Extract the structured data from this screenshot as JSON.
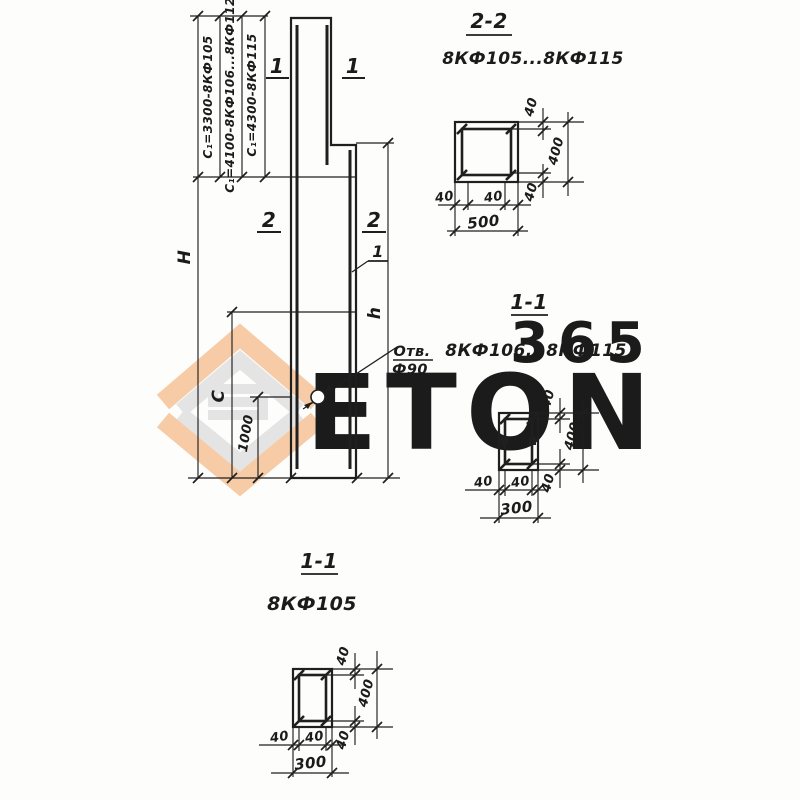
{
  "watermark": {
    "number": "365",
    "brand": "ETON",
    "orange": "#f6cba6",
    "gray": "#e4e4e4",
    "number_color": "#f1bc9c"
  },
  "elevation": {
    "c1_labels": [
      "С₁=3300-8КФ105",
      "С₁=4100-8КФ106...8КФ112",
      "С₁=4300-8КФ115"
    ],
    "total_height_label": "Н",
    "c_label": "С",
    "hole_offset_label": "1000",
    "h_label": "h",
    "hole_note_line1": "Отв.",
    "hole_note_line2": "Ф90",
    "cut1_left": "1",
    "cut1_right": "1",
    "cut2_left": "2",
    "cut2_right": "2",
    "rebar_mark": "1"
  },
  "section22": {
    "title": "2-2",
    "range": "8КФ105...8КФ115",
    "cover_top": "40",
    "cover_bottom": "40",
    "cover_left": "40",
    "cover_right": "40",
    "height": "400",
    "width": "500"
  },
  "section11r": {
    "title": "1-1",
    "range": "8КФ106...8КФ115",
    "cover_top": "40",
    "cover_bottom": "40",
    "cover_left": "40",
    "cover_right": "40",
    "height": "400",
    "width": "300"
  },
  "section11b": {
    "title": "1-1",
    "range": "8КФ105",
    "cover_top": "40",
    "cover_bottom": "40",
    "cover_left": "40",
    "cover_right": "40",
    "height": "400",
    "width": "300"
  }
}
